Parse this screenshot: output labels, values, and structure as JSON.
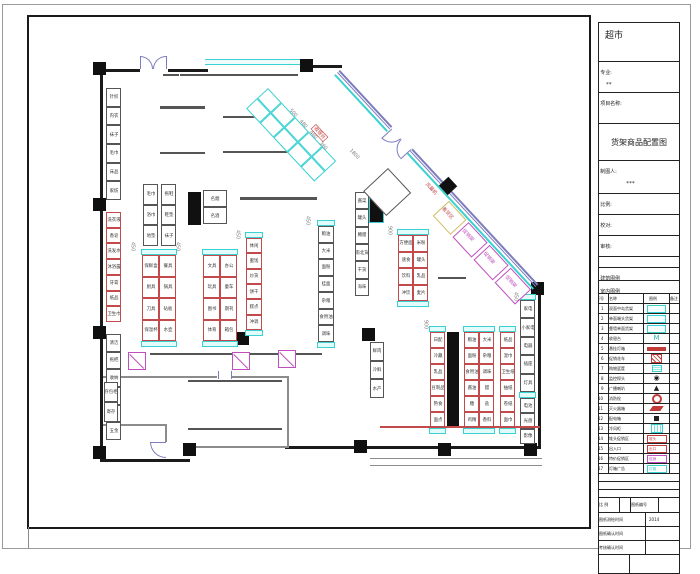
{
  "title_block": {
    "store_name": "超市",
    "major_label": "专业:",
    "major_value": "**",
    "project_label": "项目名称:",
    "drawing_title": "货架商品配置图",
    "drafter_label": "制图人:",
    "drafter_value": "***",
    "scale_label": "比例:",
    "check_label": "校对:",
    "review_label": "审核:",
    "arch_legend_label": "建筑图例",
    "interior_legend_label": "室内图例"
  },
  "legend": {
    "headers": [
      "序号",
      "名称",
      "图例",
      "备注"
    ],
    "rows": [
      {
        "no": "1",
        "name": "双面中岛货架",
        "sym": "shelf"
      },
      {
        "no": "2",
        "name": "单面端头货架",
        "sym": "shelf"
      },
      {
        "no": "3",
        "name": "靠墙单面货架",
        "sym": "shelf"
      },
      {
        "no": "4",
        "name": "收银台",
        "sym": "m",
        "text": "M"
      },
      {
        "no": "5",
        "name": "悬挂灯箱",
        "sym": "bar"
      },
      {
        "no": "6",
        "name": "促销花车",
        "sym": "redx"
      },
      {
        "no": "7",
        "name": "购物篮筐",
        "sym": "basket"
      },
      {
        "no": "8",
        "name": "监控探头",
        "sym": "cam",
        "text": "◉"
      },
      {
        "no": "9",
        "name": "广播喇叭",
        "sym": "dome",
        "text": "▲"
      },
      {
        "no": "10",
        "name": "消防栓",
        "sym": "ring"
      },
      {
        "no": "11",
        "name": "灭火器箱",
        "sym": "para"
      },
      {
        "no": "12",
        "name": "配电箱",
        "sym": "sq"
      },
      {
        "no": "13",
        "name": "冷风柜",
        "sym": "chatch"
      },
      {
        "no": "14",
        "name": "堆头促销区",
        "sym": "boxr",
        "text": "堆头"
      },
      {
        "no": "15",
        "name": "出入口",
        "sym": "boxr",
        "text": "出口"
      },
      {
        "no": "16",
        "name": "特价促销区",
        "sym": "boxm",
        "text": "促销"
      },
      {
        "no": "17",
        "name": "灯箱广告",
        "sym": "boxc",
        "text": "灯箱"
      }
    ],
    "empty_rows": 3
  },
  "footer": {
    "row1": [
      "比 例",
      "",
      "图纸编号",
      ""
    ],
    "rows": [
      {
        "label": "图纸测绘时间",
        "value": "2014"
      },
      {
        "label": "图纸确认时间",
        "value": ""
      },
      {
        "label": "考核确认时间",
        "value": ""
      }
    ]
  },
  "plan": {
    "walls": [
      {
        "x": 100,
        "y": 69,
        "w": 40,
        "h": 3,
        "c": "wk"
      },
      {
        "x": 168,
        "y": 69,
        "w": 40,
        "h": 3,
        "c": "wk"
      },
      {
        "x": 205,
        "y": 59,
        "w": 102,
        "h": 6,
        "c": "wcy"
      },
      {
        "x": 306,
        "y": 65,
        "w": 36,
        "h": 3,
        "c": "wk"
      },
      {
        "x": 100,
        "y": 69,
        "w": 3,
        "h": 393,
        "c": "wk"
      },
      {
        "x": 538,
        "y": 285,
        "w": 3,
        "h": 164,
        "c": "wk"
      },
      {
        "x": 534,
        "y": 292,
        "w": 1,
        "h": 153,
        "c": "wc1"
      },
      {
        "x": 285,
        "y": 446,
        "w": 256,
        "h": 3,
        "c": "wk"
      },
      {
        "x": 100,
        "y": 459,
        "w": 90,
        "h": 3,
        "c": "wk"
      },
      {
        "x": 103,
        "y": 376,
        "w": 114,
        "h": 2,
        "c": "wg"
      },
      {
        "x": 232,
        "y": 376,
        "w": 57,
        "h": 2,
        "c": "wg"
      },
      {
        "x": 287,
        "y": 376,
        "w": 2,
        "h": 72,
        "c": "wg"
      },
      {
        "x": 188,
        "y": 446,
        "w": 100,
        "h": 2,
        "c": "wg"
      },
      {
        "x": 103,
        "y": 424,
        "w": 64,
        "h": 2,
        "c": "wg"
      },
      {
        "x": 165,
        "y": 424,
        "w": 2,
        "h": 18,
        "c": "wg"
      },
      {
        "x": 218,
        "y": 371,
        "w": 1,
        "h": 8,
        "c": "wb"
      },
      {
        "x": 231,
        "y": 371,
        "w": 1,
        "h": 8,
        "c": "wb"
      },
      {
        "x": 370,
        "y": 458,
        "w": 172,
        "h": 1,
        "c": "wg"
      },
      {
        "x": 370,
        "y": 465,
        "w": 172,
        "h": 1,
        "c": "wg"
      },
      {
        "x": 28,
        "y": 527,
        "w": 1,
        "h": 21,
        "c": "wg"
      }
    ],
    "columns": [
      [
        93,
        62
      ],
      [
        300,
        59
      ],
      [
        93,
        198
      ],
      [
        93,
        326
      ],
      [
        93,
        446
      ],
      [
        183,
        443
      ],
      [
        354,
        440
      ],
      [
        438,
        443
      ],
      [
        524,
        443
      ],
      [
        531,
        282
      ],
      [
        236,
        332
      ],
      [
        362,
        328
      ]
    ],
    "blacks": [
      {
        "x": 188,
        "y": 192,
        "w": 13,
        "h": 33
      },
      {
        "x": 447,
        "y": 332,
        "w": 12,
        "h": 96
      },
      {
        "x": 369,
        "y": 189,
        "w": 15,
        "h": 34,
        "cy": true
      }
    ],
    "runs": [
      {
        "x": 106,
        "y": 88,
        "w": 15,
        "h": 112,
        "cols": 1,
        "rows": 6,
        "st": "k",
        "labels": [
          "针织",
          "内衣",
          "袜子",
          "毛巾",
          "床品",
          "家纺"
        ]
      },
      {
        "x": 106,
        "y": 212,
        "w": 15,
        "h": 110,
        "cols": 1,
        "rows": 7,
        "st": "r",
        "labels": [
          "洗衣液",
          "香皂",
          "洗发水",
          "沐浴露",
          "牙膏",
          "纸品",
          "卫生巾"
        ]
      },
      {
        "x": 106,
        "y": 334,
        "w": 15,
        "h": 106,
        "cols": 1,
        "rows": 6,
        "st": "k",
        "labels": [
          "清洁",
          "拖把",
          "收纳",
          "衣架",
          "雨具",
          "五金"
        ]
      },
      {
        "x": 163,
        "y": 74,
        "w": 16,
        "h": 1,
        "cols": 1,
        "rows": 1,
        "st": "k",
        "labels": [
          "服务"
        ]
      },
      {
        "x": 180,
        "y": 74,
        "w": 118,
        "h": 1,
        "cols": 4,
        "rows": 1,
        "st": "k",
        "labels": [
          "休闲食品",
          "膨化食品",
          "饼干糕点",
          "糖果蜜饯"
        ]
      },
      {
        "x": 160,
        "y": 106,
        "w": 45,
        "h": 1,
        "cols": 2,
        "rows": 2,
        "st": "k",
        "labels": [
          "915 百货",
          "916 百货",
          "917 百货",
          "918 百货"
        ]
      },
      {
        "x": 160,
        "y": 152,
        "w": 45,
        "h": 1,
        "cols": 1,
        "rows": 1,
        "st": "k",
        "labels": [
          "百货 012"
        ]
      },
      {
        "x": 223,
        "y": 116,
        "w": 56,
        "h": 1,
        "cols": 3,
        "rows": 1,
        "st": "k",
        "labels": [
          "文具",
          "玩具",
          "精品"
        ]
      },
      {
        "x": 223,
        "y": 151,
        "w": 75,
        "h": 1,
        "cols": 4,
        "rows": 1,
        "st": "k",
        "labels": [
          "洗化",
          "纸品",
          "清洁",
          "收纳"
        ]
      },
      {
        "x": 143,
        "y": 184,
        "w": 15,
        "h": 62,
        "cols": 1,
        "rows": 3,
        "st": "k",
        "labels": [
          "毛巾",
          "浴巾",
          "地垫"
        ]
      },
      {
        "x": 161,
        "y": 184,
        "w": 15,
        "h": 62,
        "cols": 1,
        "rows": 3,
        "st": "k",
        "labels": [
          "拖鞋",
          "鞋垫",
          "袜子"
        ]
      },
      {
        "x": 142,
        "y": 255,
        "w": 34,
        "h": 86,
        "cols": 2,
        "rows": 4,
        "st": "r",
        "caps": 1,
        "labels": [
          "保鲜盒",
          "餐具",
          "厨具",
          "锅具",
          "刀具",
          "砧板",
          "保温杯",
          "水壶"
        ]
      },
      {
        "x": 203,
        "y": 190,
        "w": 24,
        "h": 34,
        "cols": 1,
        "rows": 2,
        "st": "k",
        "labels": [
          "名烟",
          "名酒"
        ]
      },
      {
        "x": 203,
        "y": 255,
        "w": 34,
        "h": 86,
        "cols": 2,
        "rows": 4,
        "st": "r",
        "caps": 1,
        "labels": [
          "文具",
          "办公",
          "玩具",
          "童车",
          "图书",
          "期刊",
          "体育",
          "箱包"
        ]
      },
      {
        "x": 240,
        "y": 197,
        "w": 77,
        "h": 1,
        "cols": 3,
        "rows": 2,
        "st": "k",
        "labels": [
          "白酒",
          "红酒",
          "啤酒",
          "饮料",
          "乳品",
          "水饮"
        ]
      },
      {
        "x": 246,
        "y": 238,
        "w": 16,
        "h": 92,
        "cols": 1,
        "rows": 6,
        "st": "r",
        "caps": 1,
        "labels": [
          "休闲",
          "蜜饯",
          "炒货",
          "饼干",
          "糕点",
          "冲调"
        ]
      },
      {
        "x": 318,
        "y": 226,
        "w": 16,
        "h": 116,
        "cols": 1,
        "rows": 7,
        "st": "k",
        "caps": 1,
        "labels": [
          "粮油",
          "大米",
          "面粉",
          "挂面",
          "杂粮",
          "食用油",
          "调味"
        ]
      },
      {
        "x": 355,
        "y": 192,
        "w": 14,
        "h": 104,
        "cols": 1,
        "rows": 6,
        "st": "k",
        "labels": [
          "酱菜",
          "罐头",
          "腌腊",
          "南北货",
          "干货",
          "海味"
        ]
      },
      {
        "x": 398,
        "y": 235,
        "w": 30,
        "h": 66,
        "cols": 2,
        "rows": 4,
        "st": "r",
        "caps": 1,
        "labels": [
          "方便面",
          "米粉",
          "速食",
          "罐头",
          "饮料",
          "乳品",
          "冲饮",
          "麦片"
        ]
      },
      {
        "x": 438,
        "y": 277,
        "w": 28,
        "h": 1,
        "cols": 2,
        "rows": 1,
        "st": "k",
        "labels": [
          "称重",
          "包装"
        ]
      },
      {
        "x": 430,
        "y": 332,
        "w": 15,
        "h": 96,
        "cols": 1,
        "rows": 6,
        "st": "r",
        "caps": 1,
        "labels": [
          "日配",
          "冷藏",
          "乳品",
          "豆制品",
          "熟食",
          "面点"
        ]
      },
      {
        "x": 464,
        "y": 332,
        "w": 30,
        "h": 96,
        "cols": 2,
        "rows": 6,
        "st": "r",
        "caps": 1,
        "labels": [
          "粮油",
          "大米",
          "面粉",
          "杂粮",
          "食用油",
          "调味",
          "酱油",
          "醋",
          "糖",
          "盐",
          "鸡精",
          "香料"
        ]
      },
      {
        "x": 500,
        "y": 332,
        "w": 15,
        "h": 96,
        "cols": 1,
        "rows": 6,
        "st": "r",
        "caps": 1,
        "labels": [
          "纸品",
          "湿巾",
          "卫生纸",
          "抽纸",
          "卷纸",
          "面巾"
        ]
      },
      {
        "x": 520,
        "y": 300,
        "w": 15,
        "h": 92,
        "cols": 1,
        "rows": 5,
        "st": "k",
        "caps": 1,
        "labels": [
          "家电",
          "小家电",
          "电器",
          "插座",
          "灯具"
        ]
      },
      {
        "x": 520,
        "y": 398,
        "w": 15,
        "h": 46,
        "cols": 1,
        "rows": 3,
        "st": "k",
        "labels": [
          "电池",
          "光盘",
          "影像"
        ]
      },
      {
        "x": 370,
        "y": 342,
        "w": 14,
        "h": 56,
        "cols": 1,
        "rows": 3,
        "st": "k",
        "labels": [
          "鲜肉",
          "冷鲜",
          "水产"
        ]
      },
      {
        "x": 150,
        "y": 353,
        "w": 82,
        "h": 1,
        "cols": 2,
        "rows": 1,
        "st": "k",
        "labels": [
          "锅具",
          "瓷器"
        ]
      },
      {
        "x": 240,
        "y": 353,
        "w": 82,
        "h": 1,
        "cols": 2,
        "rows": 1,
        "st": "k",
        "labels": [
          "炊具",
          "水具"
        ]
      },
      {
        "x": 188,
        "y": 380,
        "w": 94,
        "h": 1,
        "cols": 2,
        "rows": 1,
        "st": "k",
        "labels": [
          "仓储货架",
          "仓储货架"
        ]
      },
      {
        "x": 188,
        "y": 428,
        "w": 94,
        "h": 1,
        "cols": 2,
        "rows": 1,
        "st": "k",
        "labels": [
          "仓储货架",
          "仓储货架"
        ]
      },
      {
        "x": 380,
        "y": 426,
        "w": 160,
        "h": 1,
        "cols": 3,
        "rows": 1,
        "st": "r",
        "labels": [
          "促销区",
          "促销区",
          "特价区"
        ]
      },
      {
        "x": 104,
        "y": 382,
        "w": 14,
        "h": 40,
        "cols": 1,
        "rows": 2,
        "st": "k",
        "labels": [
          "存包柜",
          "寄存"
        ]
      },
      {
        "x": 128,
        "y": 352,
        "w": 18,
        "h": 18,
        "cols": 1,
        "rows": 1,
        "st": "m",
        "diag": 1,
        "labels": [
          ""
        ]
      },
      {
        "x": 232,
        "y": 352,
        "w": 18,
        "h": 18,
        "cols": 1,
        "rows": 1,
        "st": "m",
        "diag": 1,
        "labels": [
          ""
        ]
      },
      {
        "x": 278,
        "y": 350,
        "w": 18,
        "h": 18,
        "cols": 1,
        "rows": 1,
        "st": "m",
        "diag": 1,
        "labels": [
          ""
        ]
      }
    ],
    "rotgrid": {
      "x": 268,
      "y": 88,
      "rot": 47,
      "cols": 5,
      "rows": 2,
      "cw": 20,
      "ch": 15
    },
    "room": {
      "x": 388,
      "y": 168,
      "rot": 47,
      "s": 34
    },
    "diag": {
      "x": 340,
      "y": 70,
      "len": 292,
      "rot": 47.2,
      "door_t": 78,
      "diamond_t": 152,
      "pboxes": [
        {
          "t": 170,
          "len": 26,
          "c": "#cdbd62",
          "lc": "#c24a4a",
          "label": "看货区"
        },
        {
          "t": 199,
          "len": 28,
          "c": "#bf4fbf",
          "lc": "#bf4fbf",
          "label": "促销架"
        },
        {
          "t": 230,
          "len": 28,
          "c": "#bf4fbf",
          "lc": "#bf4fbf",
          "label": "促销架"
        },
        {
          "t": 261,
          "len": 30,
          "c": "#bf4fbf",
          "lc": "#bf4fbf",
          "label": "促销架"
        }
      ]
    },
    "texts": [
      {
        "x": 316,
        "y": 124,
        "t": "收银台",
        "c": "red",
        "rot": 47,
        "box": true
      },
      {
        "x": 428,
        "y": 182,
        "t": "风幕机",
        "c": "red",
        "rot": 47
      },
      {
        "x": 292,
        "y": 108,
        "t": "500",
        "c": "dim",
        "rot": 47
      },
      {
        "x": 302,
        "y": 119,
        "t": "480",
        "c": "dim",
        "rot": 47
      },
      {
        "x": 312,
        "y": 130,
        "t": "460",
        "c": "dim",
        "rot": 47
      },
      {
        "x": 322,
        "y": 141,
        "t": "360",
        "c": "dim",
        "rot": 47
      },
      {
        "x": 352,
        "y": 148,
        "t": "1800",
        "c": "dim",
        "rot": 47
      },
      {
        "x": 135,
        "y": 242,
        "t": "450",
        "c": "dim",
        "rot": 90
      },
      {
        "x": 180,
        "y": 242,
        "t": "450",
        "c": "dim",
        "rot": 90
      },
      {
        "x": 240,
        "y": 230,
        "t": "450",
        "c": "dim",
        "rot": 90
      },
      {
        "x": 310,
        "y": 216,
        "t": "450",
        "c": "dim",
        "rot": 90
      },
      {
        "x": 392,
        "y": 226,
        "t": "900",
        "c": "dim",
        "rot": 90
      },
      {
        "x": 428,
        "y": 320,
        "t": "900",
        "c": "dim",
        "rot": 90
      },
      {
        "x": 518,
        "y": 292,
        "t": "450",
        "c": "dim",
        "rot": 90
      }
    ]
  }
}
